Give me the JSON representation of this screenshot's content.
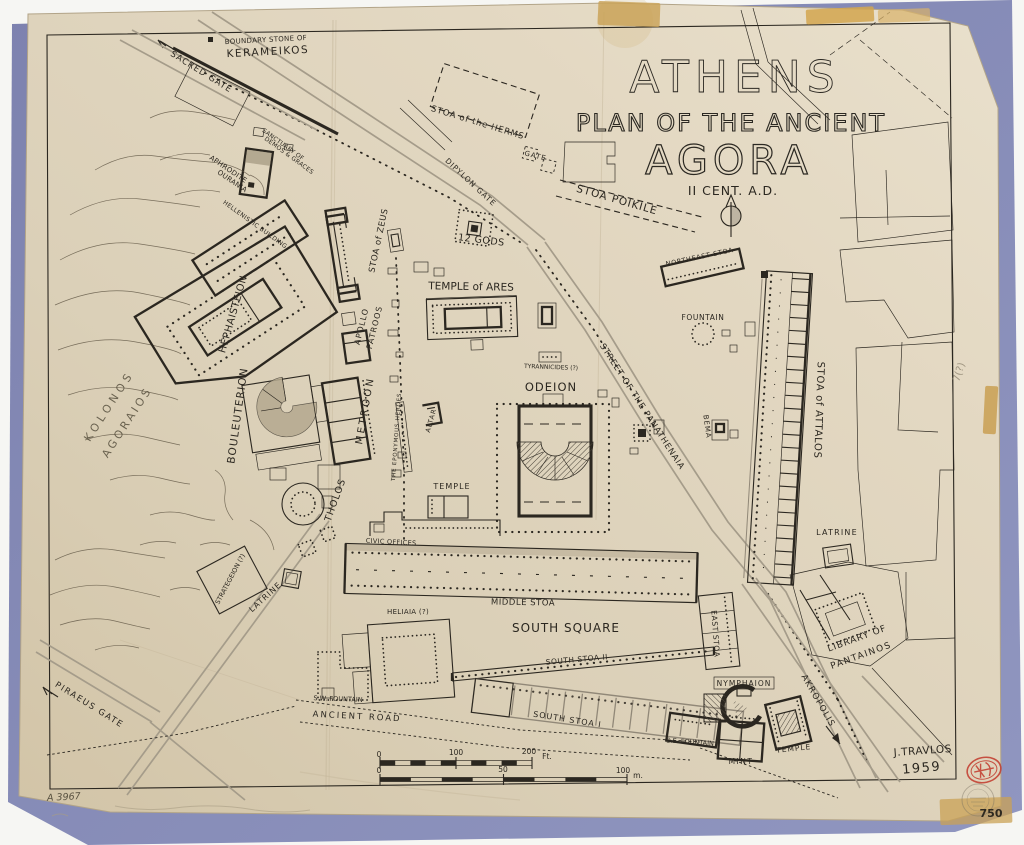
{
  "document": {
    "title_line1": "ATHENS",
    "title_line2": "PLAN OF THE ANCIENT",
    "title_line3": "AGORA",
    "subtitle": "II CENT. A.D.",
    "author": "J.TRAVLOS",
    "year": "1959",
    "catalog_number": "A 3967",
    "plate_number": "750",
    "margin_note": "7(?)",
    "ink_color": "#2b2720",
    "paper_color": "#ddd2bc",
    "mat_color": "#8287b5",
    "stamp_color": "#c23a2c"
  },
  "scale_bars": {
    "feet": {
      "ticks": [
        "0",
        "100",
        "200"
      ],
      "unit": "Ft."
    },
    "meters": {
      "ticks": [
        "0",
        "50",
        "100"
      ],
      "unit": "m."
    }
  },
  "map_labels": [
    {
      "name": "label-boundary-stone-1",
      "text": "BOUNDARY STONE OF",
      "x": 266,
      "y": 42,
      "rot": -3,
      "size": 7,
      "ls": 0.3
    },
    {
      "name": "label-boundary-stone-2",
      "text": "KERAMEIKOS",
      "x": 268,
      "y": 55,
      "rot": -3,
      "size": 10.5,
      "ls": 1.5
    },
    {
      "name": "label-sacred-gate",
      "text": "SACRED GATE",
      "x": 200,
      "y": 74,
      "rot": 32,
      "size": 8.5,
      "ls": 1
    },
    {
      "name": "label-sanctuary-demos-1",
      "text": "SANCTUARY OF",
      "x": 282,
      "y": 146,
      "rot": 36,
      "size": 6,
      "ls": 0.3
    },
    {
      "name": "label-sanctuary-demos-2",
      "text": "DEMOS & GRACES",
      "x": 288,
      "y": 157,
      "rot": 36,
      "size": 6,
      "ls": 0.3
    },
    {
      "name": "label-aphrodite-1",
      "text": "APHRODITE",
      "x": 227,
      "y": 171,
      "rot": 34,
      "size": 7,
      "ls": 0.3
    },
    {
      "name": "label-aphrodite-2",
      "text": "OURANIA",
      "x": 231,
      "y": 183,
      "rot": 34,
      "size": 7,
      "ls": 0.3
    },
    {
      "name": "label-hellenistic-building",
      "text": "HELLENISTIC BUILDING",
      "x": 254,
      "y": 226,
      "rot": 36,
      "size": 6,
      "ls": 0.4
    },
    {
      "name": "label-hephaisteion",
      "text": "HEPHAISTEION",
      "x": 236,
      "y": 315,
      "rot": -74,
      "size": 10,
      "ls": 0.5
    },
    {
      "name": "label-kolonos-1",
      "text": "KOLONOS",
      "x": 112,
      "y": 408,
      "rot": -57,
      "size": 11,
      "ls": 4,
      "cls": "ghost"
    },
    {
      "name": "label-kolonos-2",
      "text": "AGORAIOS",
      "x": 130,
      "y": 424,
      "rot": -57,
      "size": 11,
      "ls": 3,
      "cls": "ghost"
    },
    {
      "name": "label-bouleuterion",
      "text": "BOULEUTERION",
      "x": 241,
      "y": 416,
      "rot": -82,
      "size": 10.5,
      "ls": 1.2
    },
    {
      "name": "label-metroon",
      "text": "METROON",
      "x": 368,
      "y": 411,
      "rot": -80,
      "size": 10,
      "ls": 2.5
    },
    {
      "name": "label-apollo-1",
      "text": "APOLLO",
      "x": 364,
      "y": 327,
      "rot": -76,
      "size": 8,
      "ls": 1
    },
    {
      "name": "label-apollo-2",
      "text": "PATROOS",
      "x": 377,
      "y": 328,
      "rot": -76,
      "size": 8,
      "ls": 1
    },
    {
      "name": "label-stoa-zeus",
      "text": "STOA of ZEUS",
      "x": 381,
      "y": 241,
      "rot": -78,
      "size": 8.5,
      "ls": 0.5
    },
    {
      "name": "label-stoa-herms",
      "text": "STOA of the HERMS",
      "x": 477,
      "y": 125,
      "rot": 17,
      "size": 8.5,
      "ls": 0.8
    },
    {
      "name": "label-gate",
      "text": "GATE",
      "x": 535,
      "y": 158,
      "rot": 14,
      "size": 7,
      "ls": 1
    },
    {
      "name": "label-dipylon-gate",
      "text": "DIPYLON GATE",
      "x": 469,
      "y": 184,
      "rot": 43,
      "size": 7.5,
      "ls": 1
    },
    {
      "name": "label-stoa-poikile",
      "text": "STOA POIKILE",
      "x": 616,
      "y": 203,
      "rot": 16,
      "size": 10.5,
      "ls": 1
    },
    {
      "name": "label-twelve-gods",
      "text": "12 GODS",
      "x": 481,
      "y": 243,
      "rot": 7,
      "size": 9.5,
      "ls": 0.5
    },
    {
      "name": "label-temple-ares",
      "text": "TEMPLE of ARES",
      "x": 471,
      "y": 290,
      "rot": 1,
      "size": 10.5,
      "ls": 0
    },
    {
      "name": "label-tyrannicides",
      "text": "TYRANNICIDES (?)",
      "x": 551,
      "y": 369,
      "rot": 2,
      "size": 6,
      "ls": 0
    },
    {
      "name": "label-street-panathenaia",
      "text": "STREET OF THE PANATHENAIA",
      "x": 640,
      "y": 408,
      "rot": 57,
      "size": 8.5,
      "ls": 0.8
    },
    {
      "name": "label-northeast-stoa",
      "text": "NORTHEAST STOA",
      "x": 700,
      "y": 259,
      "rot": -12,
      "size": 6.5,
      "ls": 0.7
    },
    {
      "name": "label-fountain-north",
      "text": "FOUNTAIN",
      "x": 703,
      "y": 320,
      "rot": 0,
      "size": 7.5,
      "ls": 0.6
    },
    {
      "name": "label-bema",
      "text": "BEMA",
      "x": 705,
      "y": 427,
      "rot": 82,
      "size": 7,
      "ls": 1
    },
    {
      "name": "label-stoa-attalos",
      "text": "STOA of ATTALOS",
      "x": 816,
      "y": 410,
      "rot": 92,
      "size": 10,
      "ls": 0.7
    },
    {
      "name": "label-latrine-ne",
      "text": "LATRINE",
      "x": 837,
      "y": 535,
      "rot": 0,
      "size": 8,
      "ls": 1.2
    },
    {
      "name": "label-odeion",
      "text": "ODEION",
      "x": 551,
      "y": 391,
      "rot": 0,
      "size": 11.5,
      "ls": 1
    },
    {
      "name": "label-altar",
      "text": "ALTAR",
      "x": 433,
      "y": 421,
      "rot": -74,
      "size": 6.5,
      "ls": 1
    },
    {
      "name": "label-eponymous-heroes",
      "text": "THE EPONYMOUS HEROES",
      "x": 398,
      "y": 437,
      "rot": -86,
      "size": 5.5,
      "ls": 0.8
    },
    {
      "name": "label-tholos",
      "text": "THOLOS",
      "x": 338,
      "y": 501,
      "rot": -70,
      "size": 9.5,
      "ls": 1
    },
    {
      "name": "label-temple-central",
      "text": "TEMPLE",
      "x": 452,
      "y": 489,
      "rot": 0,
      "size": 8,
      "ls": 1
    },
    {
      "name": "label-civic-offices",
      "text": "CIVIC OFFICES",
      "x": 391,
      "y": 544,
      "rot": 3,
      "size": 6.5,
      "ls": 0.3
    },
    {
      "name": "label-middle-stoa",
      "text": "MIDDLE STOA",
      "x": 523,
      "y": 605,
      "rot": 1,
      "size": 8.5,
      "ls": 0.5
    },
    {
      "name": "label-heliaia",
      "text": "HELIAIA (?)",
      "x": 408,
      "y": 614,
      "rot": 0,
      "size": 7,
      "ls": 0.3
    },
    {
      "name": "label-south-square",
      "text": "SOUTH SQUARE",
      "x": 566,
      "y": 632,
      "rot": 0,
      "size": 12,
      "ls": 1
    },
    {
      "name": "label-south-stoa-2",
      "text": "SOUTH STOA II",
      "x": 577,
      "y": 662,
      "rot": -5,
      "size": 7.5,
      "ls": 0.5
    },
    {
      "name": "label-east-stoa",
      "text": "EAST STOA",
      "x": 713,
      "y": 634,
      "rot": 86,
      "size": 7.5,
      "ls": 0.6
    },
    {
      "name": "label-sw-fountain",
      "text": "S.W. FOUNTAIN",
      "x": 338,
      "y": 701,
      "rot": 2,
      "size": 6.5,
      "ls": 0
    },
    {
      "name": "label-ancient-road",
      "text": "ANCIENT ROAD",
      "x": 357,
      "y": 719,
      "rot": 3,
      "size": 8.5,
      "ls": 2
    },
    {
      "name": "label-south-stoa-1",
      "text": "SOUTH STOA I",
      "x": 567,
      "y": 722,
      "rot": 9,
      "size": 8,
      "ls": 1
    },
    {
      "name": "label-se-fountain",
      "text": "S.E. FOUNTAIN",
      "x": 690,
      "y": 744,
      "rot": 4,
      "size": 6.5,
      "ls": 0
    },
    {
      "name": "label-nymphaion",
      "text": "NYMPHAION",
      "x": 744,
      "y": 686,
      "rot": 0,
      "size": 7.5,
      "ls": 1
    },
    {
      "name": "label-mint",
      "text": "MINT",
      "x": 741,
      "y": 764,
      "rot": 0,
      "size": 7.5,
      "ls": 1.5
    },
    {
      "name": "label-temple-south",
      "text": "TEMPLE",
      "x": 794,
      "y": 751,
      "rot": -6,
      "size": 7.5,
      "ls": 1
    },
    {
      "name": "label-library-1",
      "text": "LIBRARY OF",
      "x": 858,
      "y": 641,
      "rot": -20,
      "size": 9,
      "ls": 1
    },
    {
      "name": "label-library-2",
      "text": "PANTAINOS",
      "x": 862,
      "y": 658,
      "rot": -20,
      "size": 9,
      "ls": 1.5
    },
    {
      "name": "label-akropolis",
      "text": "AKROPOLIS",
      "x": 816,
      "y": 702,
      "rot": 60,
      "size": 8.5,
      "ls": 1.2
    },
    {
      "name": "label-piraeus-gate",
      "text": "PIRAEUS GATE",
      "x": 88,
      "y": 707,
      "rot": 32,
      "size": 8.5,
      "ls": 1.5
    },
    {
      "name": "label-strategeion",
      "text": "STRATEGEION (?)",
      "x": 232,
      "y": 580,
      "rot": -62,
      "size": 6.5,
      "ls": 0
    },
    {
      "name": "label-latrine-sw",
      "text": "LATRINE",
      "x": 267,
      "y": 599,
      "rot": -42,
      "size": 8,
      "ls": 1
    },
    {
      "name": "label-author",
      "text": "J.TRAVLOS",
      "x": 923,
      "y": 754,
      "rot": -4,
      "size": 10.5,
      "ls": 0.5
    },
    {
      "name": "label-year",
      "text": "1959",
      "x": 922,
      "y": 772,
      "rot": -5,
      "size": 13,
      "ls": 1.5
    },
    {
      "name": "label-catalog-number",
      "text": "A 3967",
      "x": 64,
      "y": 800,
      "rot": -3,
      "size": 9.5,
      "cls": "hand"
    },
    {
      "name": "label-plate-number",
      "text": "750",
      "x": 991,
      "y": 817,
      "rot": 0,
      "size": 11,
      "cls": "plate"
    },
    {
      "name": "label-margin-note",
      "text": "7(?)",
      "x": 962,
      "y": 373,
      "rot": -72,
      "size": 10,
      "cls": "faint"
    },
    {
      "name": "scale-feet-0",
      "text": "0",
      "x": 379,
      "y": 757,
      "rot": 0,
      "size": 7.5
    },
    {
      "name": "scale-feet-100",
      "text": "100",
      "x": 456,
      "y": 755,
      "rot": 0,
      "size": 7.5
    },
    {
      "name": "scale-feet-200",
      "text": "200",
      "x": 529,
      "y": 754,
      "rot": 0,
      "size": 7.5
    },
    {
      "name": "scale-feet-unit",
      "text": "Ft.",
      "x": 547,
      "y": 759,
      "rot": 0,
      "size": 7.5
    },
    {
      "name": "scale-m-0",
      "text": "0",
      "x": 379,
      "y": 773,
      "rot": 0,
      "size": 7.5
    },
    {
      "name": "scale-m-50",
      "text": "50",
      "x": 503,
      "y": 772,
      "rot": 0,
      "size": 7.5
    },
    {
      "name": "scale-m-100",
      "text": "100",
      "x": 623,
      "y": 773,
      "rot": 0,
      "size": 7.5
    },
    {
      "name": "scale-m-unit",
      "text": "m.",
      "x": 638,
      "y": 778,
      "rot": 0,
      "size": 7.5
    }
  ]
}
